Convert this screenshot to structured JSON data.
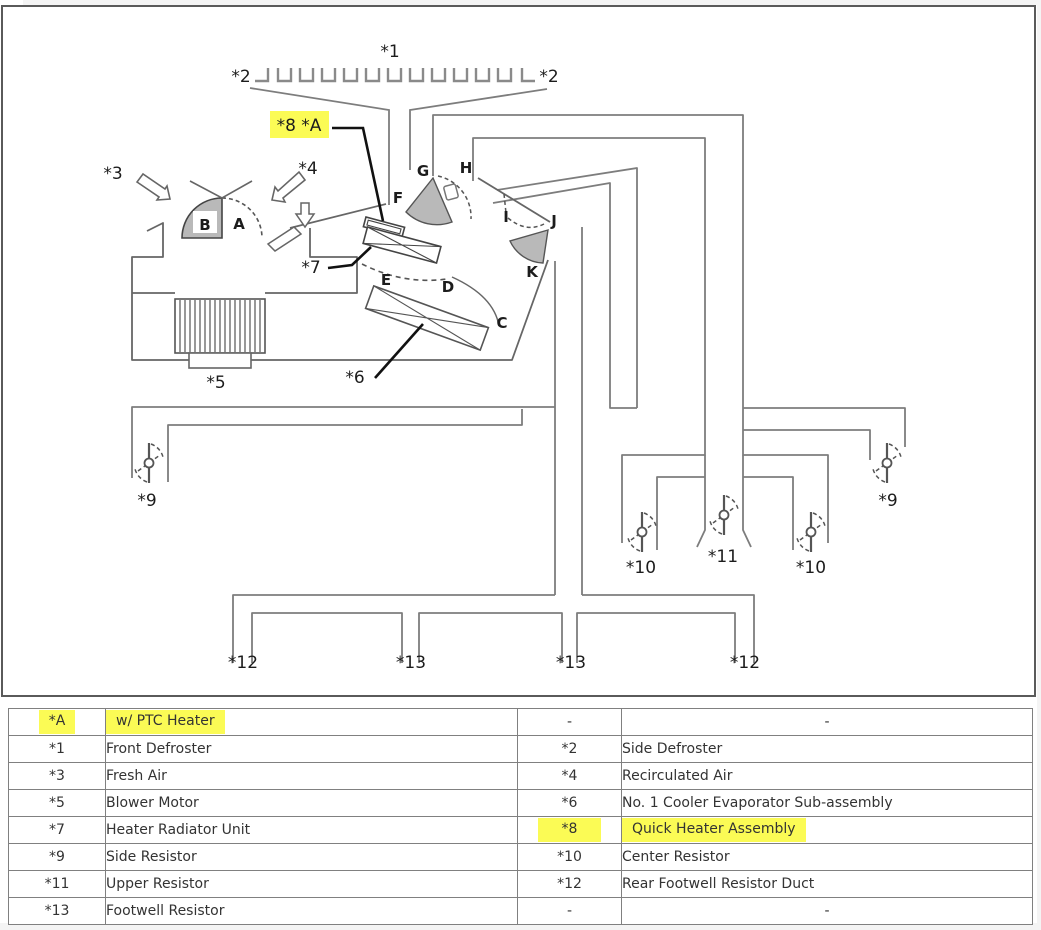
{
  "colors": {
    "highlight": "#fbfb55",
    "damper_fill": "#b9b9b9",
    "duct_line": "#7d7d7d",
    "unit_line": "#666666"
  },
  "diagram": {
    "callout_8a": "*8 *A",
    "labels": {
      "front_defroster": "*1",
      "side_defroster_left": "*2",
      "side_defroster_right": "*2",
      "fresh_air": "*3",
      "recirculated_air": "*4",
      "blower_motor": "*5",
      "evaporator": "*6",
      "heater_radiator": "*7",
      "side_resistor_left": "*9",
      "side_resistor_right": "*9",
      "center_resistor_left": "*10",
      "center_resistor_right": "*10",
      "upper_resistor": "*11",
      "rear_footwell_duct_left": "*12",
      "rear_footwell_duct_right": "*12",
      "footwell_resistor_left": "*13",
      "footwell_resistor_right": "*13"
    },
    "letters": {
      "a": "A",
      "b": "B",
      "c": "C",
      "d": "D",
      "e": "E",
      "f": "F",
      "g": "G",
      "h": "H",
      "i": "I",
      "j": "J",
      "k": "K"
    }
  },
  "legend_table": {
    "rows": [
      {
        "c1": "*A",
        "c2": "w/ PTC Heater",
        "c3": "-",
        "c4": "-"
      },
      {
        "c1": "*1",
        "c2": "Front Defroster",
        "c3": "*2",
        "c4": "Side Defroster"
      },
      {
        "c1": "*3",
        "c2": "Fresh Air",
        "c3": "*4",
        "c4": "Recirculated Air"
      },
      {
        "c1": "*5",
        "c2": "Blower Motor",
        "c3": "*6",
        "c4": "No. 1 Cooler Evaporator Sub-assembly"
      },
      {
        "c1": "*7",
        "c2": "Heater Radiator Unit",
        "c3": "*8",
        "c4": "Quick Heater Assembly"
      },
      {
        "c1": "*9",
        "c2": "Side Resistor",
        "c3": "*10",
        "c4": "Center Resistor"
      },
      {
        "c1": "*11",
        "c2": "Upper Resistor",
        "c3": "*12",
        "c4": "Rear Footwell Resistor Duct"
      },
      {
        "c1": "*13",
        "c2": "Footwell Resistor",
        "c3": "-",
        "c4": "-"
      }
    ]
  }
}
